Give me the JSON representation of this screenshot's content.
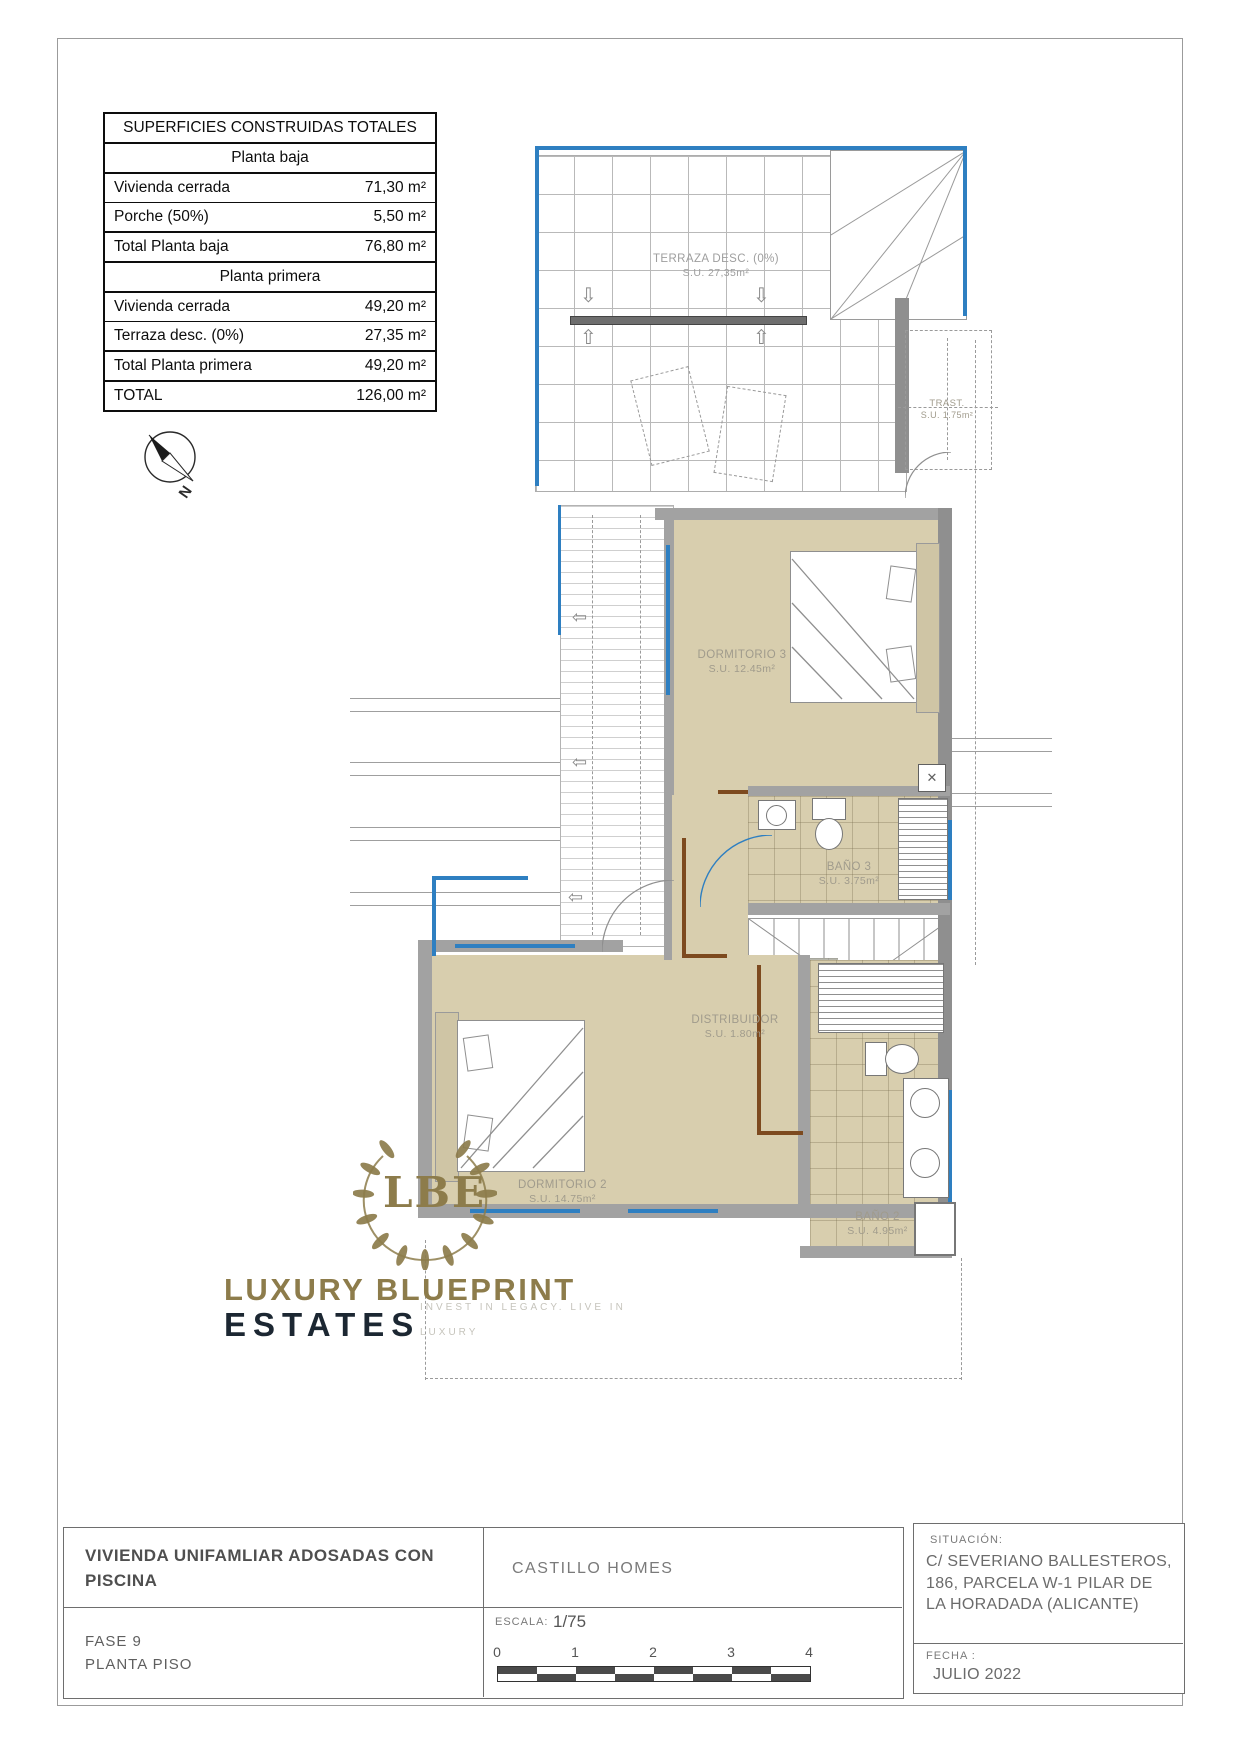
{
  "table": {
    "title": "SUPERFICIES CONSTRUIDAS TOTALES",
    "rows": [
      {
        "label": "Planta baja"
      },
      {
        "label": "Vivienda cerrada",
        "value": "71,30 m²"
      },
      {
        "label": "Porche (50%)",
        "value": "5,50 m²"
      },
      {
        "label": "Total Planta baja",
        "value": "76,80 m²"
      },
      {
        "label": "Planta primera"
      },
      {
        "label": "Vivienda cerrada",
        "value": "49,20 m²"
      },
      {
        "label": "Terraza desc. (0%)",
        "value": "27,35 m²"
      },
      {
        "label": "Total Planta primera",
        "value": "49,20 m²"
      },
      {
        "label": "TOTAL",
        "value": "126,00 m²"
      }
    ]
  },
  "plan": {
    "terraza": {
      "name": "TERRAZA DESC. (0%)",
      "area": "S.U. 27,35m²"
    },
    "trastero": {
      "name": "TRAST.",
      "area": "S.U. 1.75m²"
    },
    "dormitorio3": {
      "name": "DORMITORIO 3",
      "area": "S.U. 12.45m²"
    },
    "bano3": {
      "name": "BAÑO 3",
      "area": "S.U. 3.75m²"
    },
    "distribuidor": {
      "name": "DISTRIBUIDOR",
      "area": "S.U. 1.80m²"
    },
    "dormitorio2": {
      "name": "DORMITORIO 2",
      "area": "S.U. 14.75m²"
    },
    "bano2": {
      "name": "BAÑO 2",
      "area": "S.U. 4.95m²"
    },
    "compass_label": "N",
    "washer_mark": "✕"
  },
  "logo": {
    "monogram": "LBE",
    "line1": "LUXURY BLUEPRINT",
    "line2": "ESTATES",
    "tagline1": "INVEST IN LEGACY. LIVE IN",
    "tagline2": "LUXURY"
  },
  "titleblock": {
    "project": "VIVIENDA UNIFAMLIAR ADOSADAS CON PISCINA",
    "phase_line1": "FASE 9",
    "phase_line2": "PLANTA PISO",
    "builder": "CASTILLO HOMES",
    "scale_label": "ESCALA:",
    "scale_value": "1/75",
    "scale_ticks": [
      "0",
      "1",
      "2",
      "3",
      "4"
    ],
    "situacion_label": "SITUACIÓN:",
    "situacion_line1": "C/ SEVERIANO BALLESTEROS,",
    "situacion_line2": "186, PARCELA W-1 PILAR DE",
    "situacion_line3": "LA HORADADA (ALICANTE)",
    "fecha_label": "FECHA :",
    "fecha_value": "JULIO 2022"
  },
  "colors": {
    "accent_blue": "#2e7fc1",
    "floor_tan": "#d8ceae",
    "wall_gray": "#a2a2a2",
    "distribuidor_gray": "#b6b6ac",
    "door_brown": "#7d4a1f",
    "logo_gold": "#8d7c4b",
    "logo_navy": "#1c2732"
  }
}
